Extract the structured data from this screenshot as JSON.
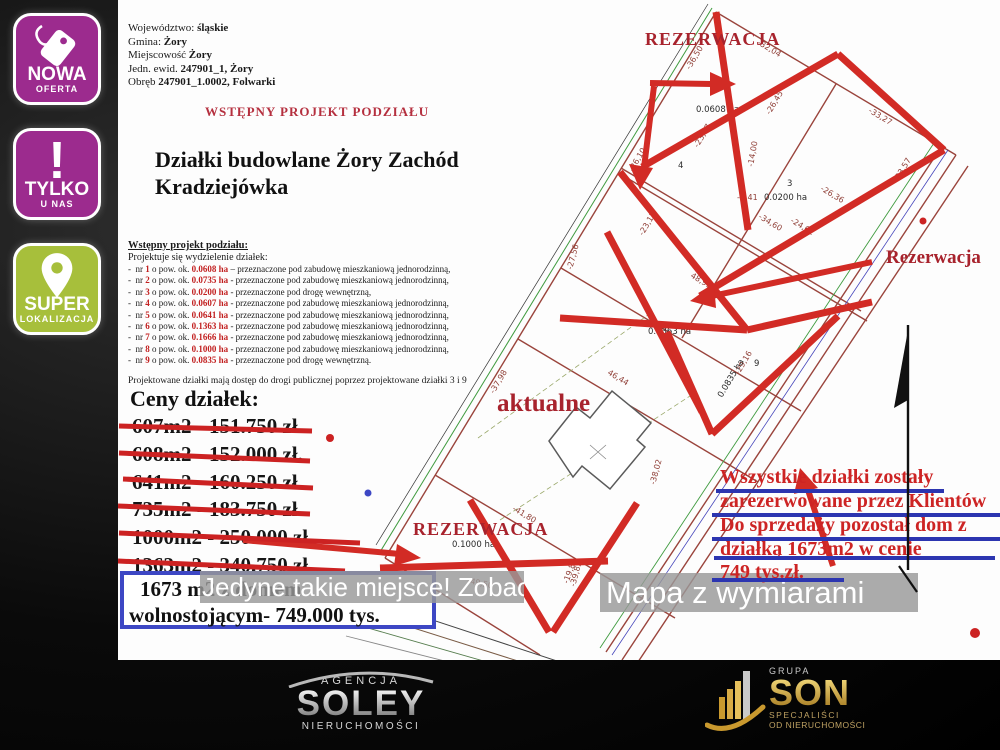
{
  "badges": [
    {
      "title": "NOWA",
      "subtitle": "OFERTA",
      "icon": "price-tag-icon",
      "color": "#9c2b8e"
    },
    {
      "title": "TYLKO",
      "subtitle": "U NAS",
      "icon": "exclamation-icon",
      "color": "#9c2b8e"
    },
    {
      "title": "SUPER",
      "subtitle": "LOKALIZACJA",
      "icon": "location-pin-icon",
      "color": "#a7bf3b"
    }
  ],
  "header": {
    "lines": [
      {
        "label": "Województwo:",
        "value": "śląskie"
      },
      {
        "label": "Gmina:",
        "value": "Żory"
      },
      {
        "label": "Miejscowość",
        "value": "Żory"
      },
      {
        "label": "Jedn. ewid.",
        "value": "247901_1, Żory"
      },
      {
        "label": "Obręb",
        "value": "247901_1.0002, Folwarki"
      }
    ],
    "project_heading": "WSTĘPNY PROJEKT PODZIAŁU",
    "title_line1": "Działki budowlane Żory Zachód",
    "title_line2": "Kradziejówka"
  },
  "plots": {
    "heading": "Wstępny projekt podziału:",
    "intro": "Projektuje się wydzielenie działek:",
    "items": [
      {
        "nr": "1",
        "area": "0.0608 ha",
        "tail": "– przeznaczone pod zabudowę mieszkaniową jednorodzinną,"
      },
      {
        "nr": "2",
        "area": "0.0735 ha",
        "tail": "- przeznaczone pod zabudowę mieszkaniową jednorodzinną,"
      },
      {
        "nr": "3",
        "area": "0.0200 ha",
        "tail": "- przeznaczone pod drogę wewnętrzną,"
      },
      {
        "nr": "4",
        "area": "0.0607 ha",
        "tail": "- przeznaczone pod zabudowę mieszkaniową jednorodzinną,"
      },
      {
        "nr": "5",
        "area": "0.0641 ha",
        "tail": "- przeznaczone pod zabudowę mieszkaniową jednorodzinną,"
      },
      {
        "nr": "6",
        "area": "0.1363 ha",
        "tail": "- przeznaczone pod zabudowę mieszkaniową jednorodzinną,"
      },
      {
        "nr": "7",
        "area": "0.1666 ha",
        "tail": "- przeznaczone pod zabudowę mieszkaniową jednorodzinną,"
      },
      {
        "nr": "8",
        "area": "0.1000 ha",
        "tail": "- przeznaczone pod zabudowę mieszkaniową jednorodzinną,"
      },
      {
        "nr": "9",
        "area": "0.0835 ha",
        "tail": "- przeznaczone pod drogę wewnętrzną."
      }
    ],
    "footer": "Projektowane działki mają dostęp do drogi publicznej poprzez projektowane działki 3 i 9"
  },
  "prices": {
    "heading": "Ceny działek:",
    "crossed": [
      "607m2 - 151.750 zł.",
      "608m2 - 152.000 zł.",
      "641m2 - 160.250 zł.",
      "735m2 - 183.750 zł.",
      "1000m2 - 250.000 zł.",
      "1363m2 - 340.750 zł."
    ],
    "final_offer_line1": "1673 m2 z domem",
    "final_offer_line2": "wolnostojącym- 749.000 tys."
  },
  "banners": {
    "left": "Jedyne takie miejsce! Zobacz!",
    "right": "Mapa z wymiarami"
  },
  "reserved_note": {
    "lines": [
      "Wszystkie działki zostały",
      "zarezerwowane przez Klientów",
      "Do sprzedaży pozostał dom z",
      "działką 1673m2 w cenie",
      "749 tys.zł."
    ]
  },
  "map": {
    "labels": [
      {
        "text": "REZERWACJA"
      },
      {
        "text": "Rezerwacja"
      },
      {
        "text": "aktualne"
      },
      {
        "text": "REZERWACJA"
      }
    ],
    "dimensions": [
      {
        "t": "-36,50",
        "x": 690,
        "y": 70,
        "r": -59
      },
      {
        "t": "-32,04",
        "x": 757,
        "y": 44,
        "r": 31
      },
      {
        "t": "-33,27",
        "x": 868,
        "y": 112,
        "r": 31
      },
      {
        "t": "-26,45",
        "x": 770,
        "y": 115,
        "r": -59
      },
      {
        "t": "-23,07",
        "x": 698,
        "y": 148,
        "r": -59
      },
      {
        "t": "-26,10",
        "x": 633,
        "y": 172,
        "r": -59
      },
      {
        "t": "-23,17",
        "x": 643,
        "y": 236,
        "r": -59
      },
      {
        "t": "-27,56",
        "x": 572,
        "y": 270,
        "r": -75
      },
      {
        "t": "48,91",
        "x": 690,
        "y": 277,
        "r": 31
      },
      {
        "t": "-26,36",
        "x": 820,
        "y": 190,
        "r": 31
      },
      {
        "t": "-23,57",
        "x": 898,
        "y": 182,
        "r": -59
      },
      {
        "t": "-14,00",
        "x": 753,
        "y": 167,
        "r": -80
      },
      {
        "t": "-6,41",
        "x": 737,
        "y": 200,
        "r": 0
      },
      {
        "t": "46,44",
        "x": 607,
        "y": 374,
        "r": 31
      },
      {
        "t": "-37,98",
        "x": 494,
        "y": 394,
        "r": -59
      },
      {
        "t": "-29,16",
        "x": 739,
        "y": 375,
        "r": -59
      },
      {
        "t": "-41,80",
        "x": 512,
        "y": 510,
        "r": 31
      },
      {
        "t": "-39,82",
        "x": 575,
        "y": 587,
        "r": -75
      },
      {
        "t": "-24,62",
        "x": 790,
        "y": 222,
        "r": 31
      },
      {
        "t": "-34,60",
        "x": 758,
        "y": 218,
        "r": 31
      },
      {
        "t": "-38,02",
        "x": 655,
        "y": 485,
        "r": -75
      },
      {
        "t": "-49,50",
        "x": 467,
        "y": 583,
        "r": 12
      },
      {
        "t": "-19,82",
        "x": 568,
        "y": 584,
        "r": -70
      }
    ],
    "parcels": [
      {
        "t": "1",
        "x": 724,
        "y": 97
      },
      {
        "t": "0.0608 ha",
        "x": 696,
        "y": 112
      },
      {
        "t": "4",
        "x": 678,
        "y": 168
      },
      {
        "t": "3",
        "x": 787,
        "y": 186
      },
      {
        "t": "0.0200 ha",
        "x": 764,
        "y": 200
      },
      {
        "t": "0.1363 ha",
        "x": 648,
        "y": 334
      },
      {
        "t": "9",
        "x": 754,
        "y": 366
      },
      {
        "t": "0.0835 ha",
        "x": 722,
        "y": 398,
        "r": -59
      },
      {
        "t": "0.1000 ha",
        "x": 452,
        "y": 547
      }
    ]
  },
  "footer_logos": {
    "soley": {
      "top": "AGENCJA",
      "name": "SOLEY",
      "bottom": "NIERUCHOMOŚCI"
    },
    "son": {
      "top": "GRUPA",
      "name": "SON",
      "bottom1": "SPECJALIŚCI",
      "bottom2": "OD NIERUCHOMOŚCI"
    }
  },
  "colors": {
    "badge_magenta": "#9c2b8e",
    "badge_green": "#a7bf3b",
    "accent_red": "#c22020",
    "annotation_red": "#d22b25",
    "accent_blue": "#2c35b0",
    "heading_crimson": "#b5303f",
    "map_label_red": "#a8232d",
    "gold": "#d1a43c"
  }
}
